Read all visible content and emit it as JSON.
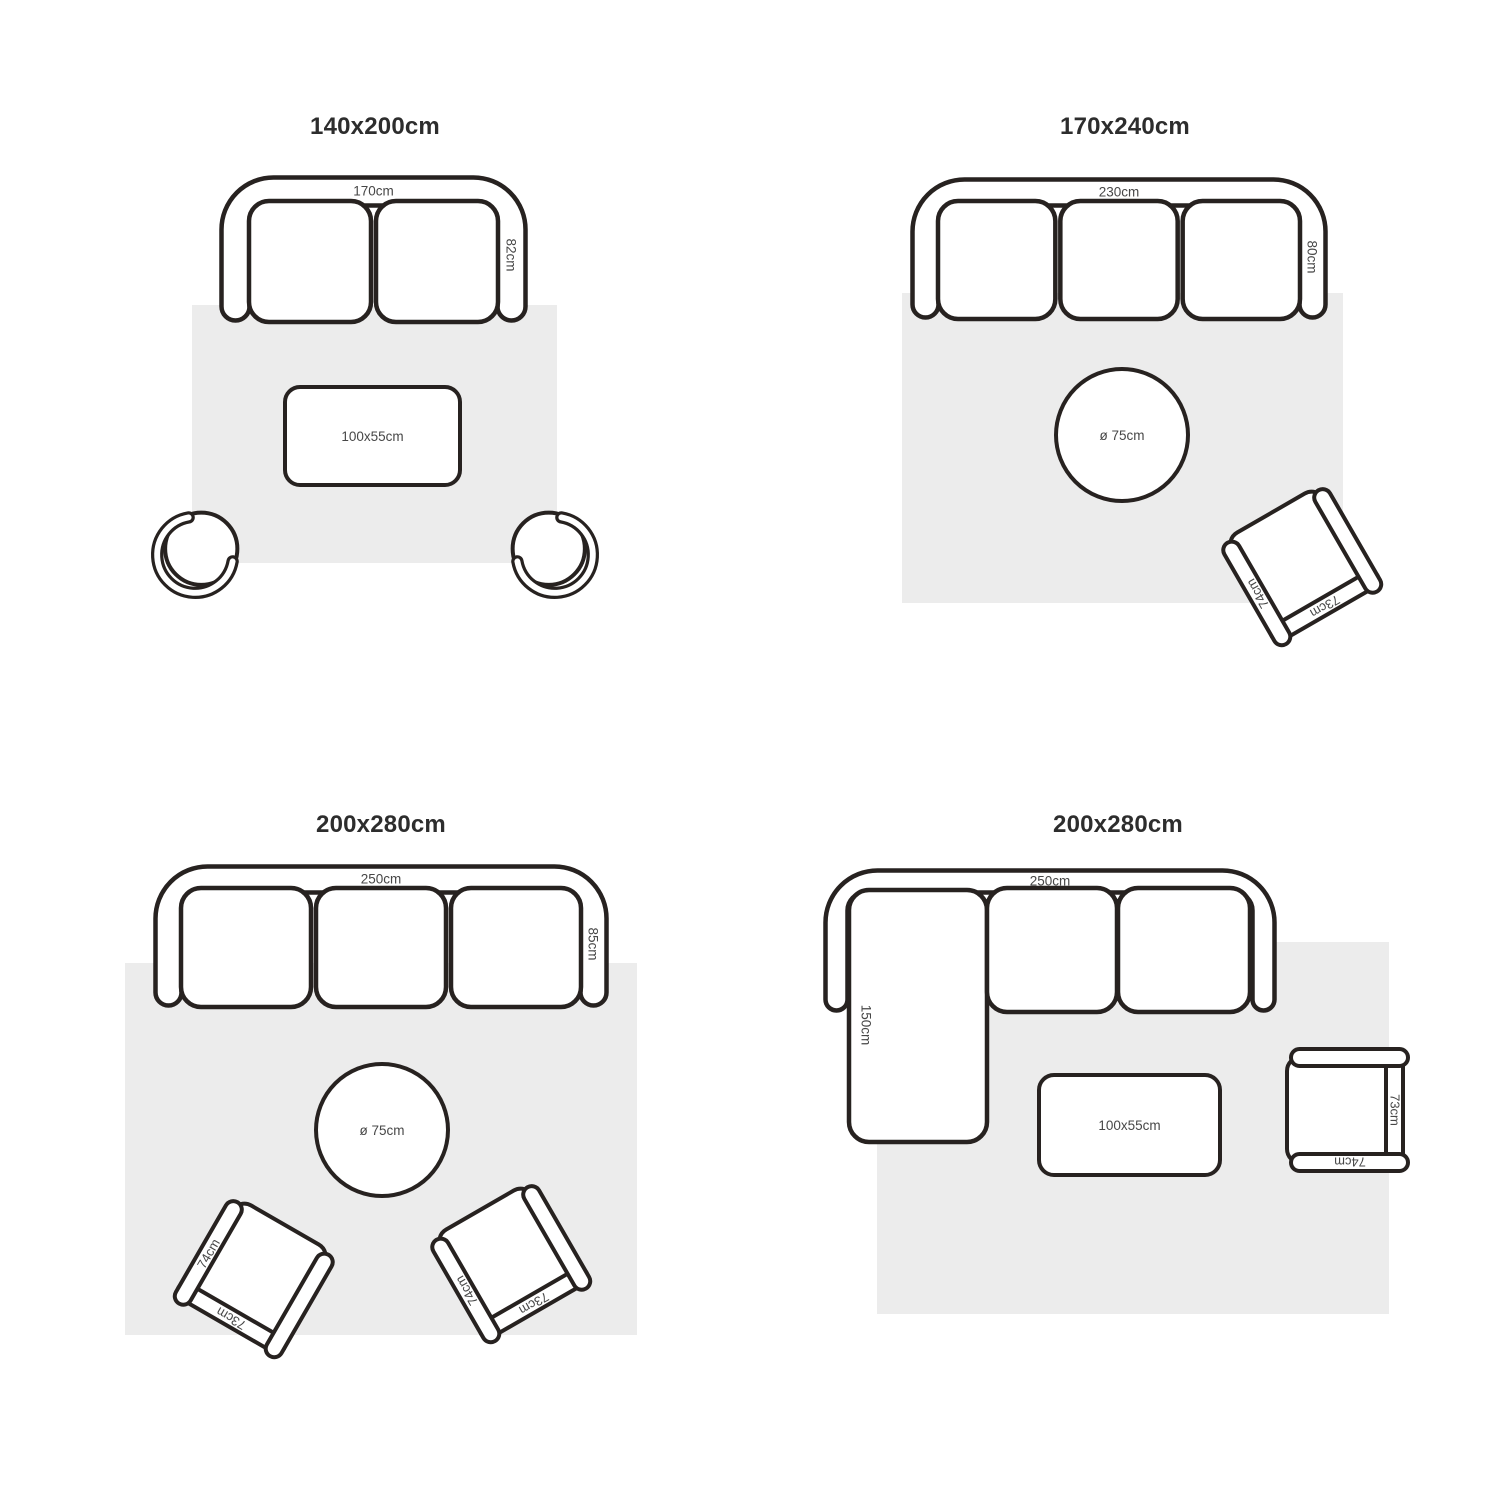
{
  "colors": {
    "line": "#272220",
    "rug": "#ececec",
    "label": "#474747",
    "title": "#2d2d2d",
    "background": "#ffffff"
  },
  "layouts": [
    {
      "id": "rug-140x200",
      "title": {
        "text": "140x200cm",
        "cx": 375,
        "cy": 130
      },
      "rug": {
        "x": 192,
        "y": 305,
        "w": 365,
        "h": 258
      },
      "sofa": {
        "style": "straight",
        "x": 219,
        "y": 175,
        "w": 309,
        "h": 148,
        "t": 28,
        "seats": 2,
        "width_label": "170cm",
        "depth_label": "82cm"
      },
      "tables": [
        {
          "shape": "rect",
          "x": 283,
          "y": 385,
          "w": 179,
          "h": 102,
          "label": "100x55cm"
        }
      ],
      "chairs": [
        {
          "kind": "tub",
          "cx": 198,
          "cy": 551,
          "flip": false
        },
        {
          "kind": "tub",
          "cx": 551,
          "cy": 551,
          "flip": true
        }
      ]
    },
    {
      "id": "rug-170x240",
      "title": {
        "text": "170x240cm",
        "cx": 1125,
        "cy": 130
      },
      "rug": {
        "x": 902,
        "y": 293,
        "w": 441,
        "h": 310
      },
      "sofa": {
        "style": "straight",
        "x": 910,
        "y": 177,
        "w": 418,
        "h": 143,
        "t": 26,
        "seats": 3,
        "width_label": "230cm",
        "depth_label": "80cm"
      },
      "tables": [
        {
          "shape": "round",
          "cx": 1122,
          "cy": 435,
          "r": 68,
          "label": "ø 75cm"
        }
      ],
      "chairs": [
        {
          "kind": "arm",
          "cx": 1301,
          "cy": 565,
          "rot": -30,
          "arm_label": "74cm",
          "back_label": "73cm"
        }
      ]
    },
    {
      "id": "rug-200x280-a",
      "title": {
        "text": "200x280cm",
        "cx": 381,
        "cy": 828
      },
      "rug": {
        "x": 125,
        "y": 963,
        "w": 512,
        "h": 372
      },
      "sofa": {
        "style": "straight",
        "x": 153,
        "y": 864,
        "w": 456,
        "h": 144,
        "t": 26,
        "seats": 3,
        "width_label": "250cm",
        "depth_label": "85cm"
      },
      "tables": [
        {
          "shape": "round",
          "cx": 382,
          "cy": 1130,
          "r": 68,
          "label": "ø 75cm"
        }
      ],
      "chairs": [
        {
          "kind": "arm",
          "cx": 255,
          "cy": 1277,
          "rot": 30,
          "arm_label": "74cm",
          "back_label": "73cm"
        },
        {
          "kind": "arm",
          "cx": 510,
          "cy": 1262,
          "rot": -30,
          "arm_label": "74cm",
          "back_label": "73cm"
        }
      ]
    },
    {
      "id": "rug-200x280-b",
      "title": {
        "text": "200x280cm",
        "cx": 1118,
        "cy": 828
      },
      "rug": {
        "x": 877,
        "y": 942,
        "w": 512,
        "h": 372
      },
      "sofa": {
        "style": "sectional",
        "x": 823,
        "y": 868,
        "w": 454,
        "h": 145,
        "t": 22,
        "width_label": "250cm",
        "chaise_label": "150cm",
        "chaise": {
          "x": 26,
          "y": 22,
          "w": 138,
          "h": 252
        },
        "cushions": [
          {
            "x": 164,
            "w": 130
          },
          {
            "x": 295,
            "w": 132
          }
        ]
      },
      "tables": [
        {
          "shape": "rect",
          "x": 1037,
          "y": 1073,
          "w": 185,
          "h": 104,
          "label": "100x55cm"
        }
      ],
      "chairs": [
        {
          "kind": "arm",
          "cx": 1347,
          "cy": 1110,
          "rot": -90,
          "arm_label": "74cm",
          "back_label": "73cm"
        }
      ]
    }
  ]
}
